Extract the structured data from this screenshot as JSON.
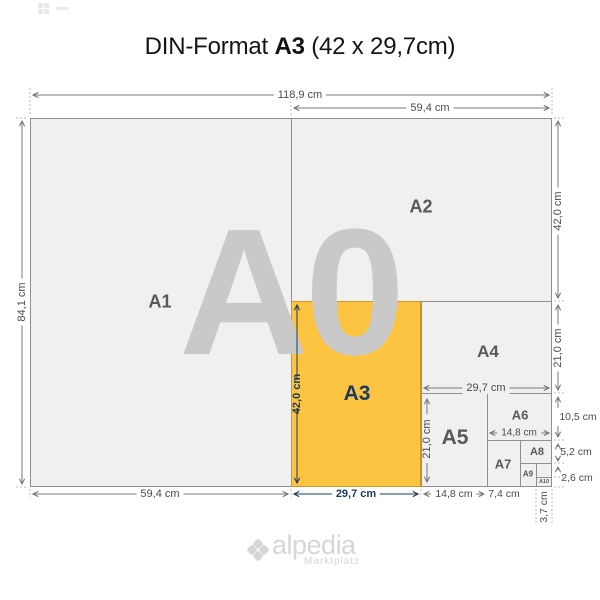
{
  "title": {
    "prefix": "DIN-Format",
    "format": "A3",
    "size_note": "(42 x 29,7cm)"
  },
  "watermark": {
    "label": "A0"
  },
  "sheets": [
    {
      "label": "A1"
    },
    {
      "label": "A2"
    },
    {
      "label": "A3"
    },
    {
      "label": "A4"
    },
    {
      "label": "A5"
    },
    {
      "label": "A6"
    },
    {
      "label": "A7"
    },
    {
      "label": "A8"
    },
    {
      "label": "A9"
    },
    {
      "label": "A10"
    }
  ],
  "dims": {
    "total_width": "118,9 cm",
    "a2_width": "59,4 cm",
    "total_height": "84,1 cm",
    "a2_height": "42,0 cm",
    "a4_height": "21,0 cm",
    "a6_height": "10,5 cm",
    "a8_height": "5,2 cm",
    "a10_height": "2,6 cm",
    "a1_width": "59,4 cm",
    "a3_width": "29,7 cm",
    "a5_width_bottom": "14,8 cm",
    "a7_width": "7,4 cm",
    "a10_width": "3,7 cm",
    "a3_height": "42,0 cm",
    "a5_height": "21,0 cm",
    "a4_width": "29,7 cm",
    "a6_width": "14,8 cm"
  },
  "colors": {
    "highlight_orange": "#fcc440",
    "highlight_border": "#c9992b",
    "accent_navy": "#1e3a5f",
    "sheet_fill": "#f0f0f0",
    "grid_line": "#8f8f8f",
    "dim_text": "#4a4a4a",
    "watermark_gray": "#c9c9c9",
    "logo_gray": "#d6d6d6"
  },
  "logo": {
    "name": "alpedia",
    "tagline": "Marktplatz"
  }
}
